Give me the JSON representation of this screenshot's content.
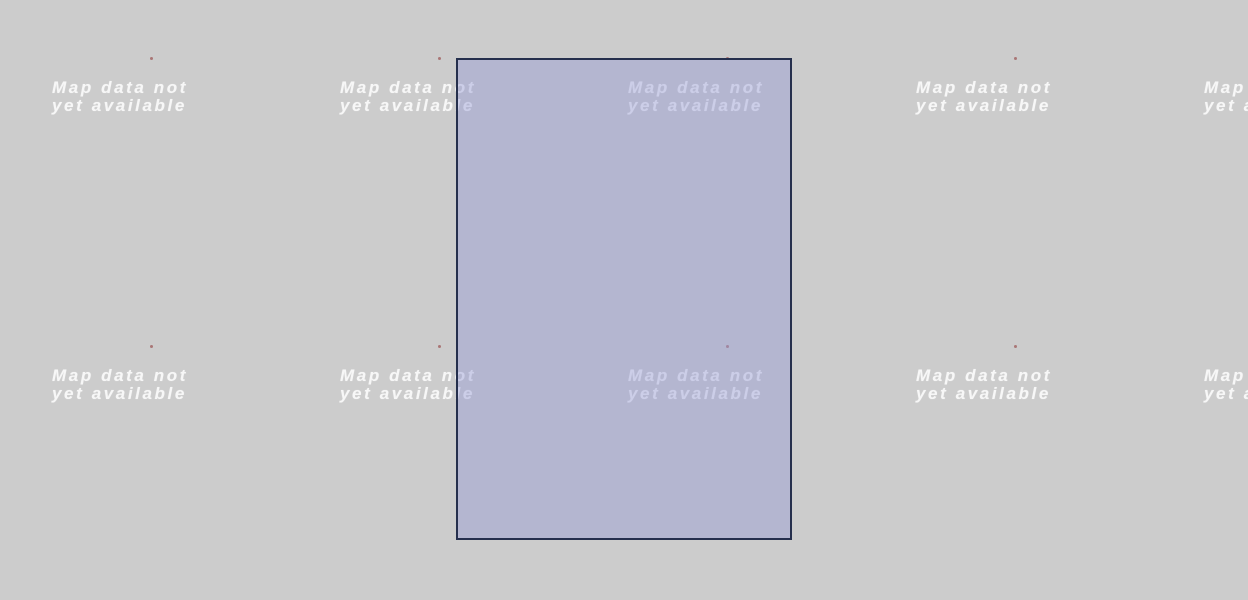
{
  "app": {
    "description": "Map viewer canvas with unloaded tile placeholders and a zoom selection rectangle"
  },
  "map": {
    "tile_placeholder": {
      "line1": "Map data not",
      "line2": "yet available"
    },
    "tile_grid": {
      "columns": 5,
      "rows": 2,
      "tile_spacing_px": 288
    },
    "marker_dots_count": 8,
    "selection_rectangle": {
      "visible": true
    }
  },
  "colors": {
    "page-bg": "#cccccc",
    "tile-text": "#f7f7f7",
    "overlay-fill": "rgba(151,155,213,0.45)",
    "overlay-border": "#252f4d",
    "marker-dot": "rgba(158,90,88,0.75)"
  }
}
